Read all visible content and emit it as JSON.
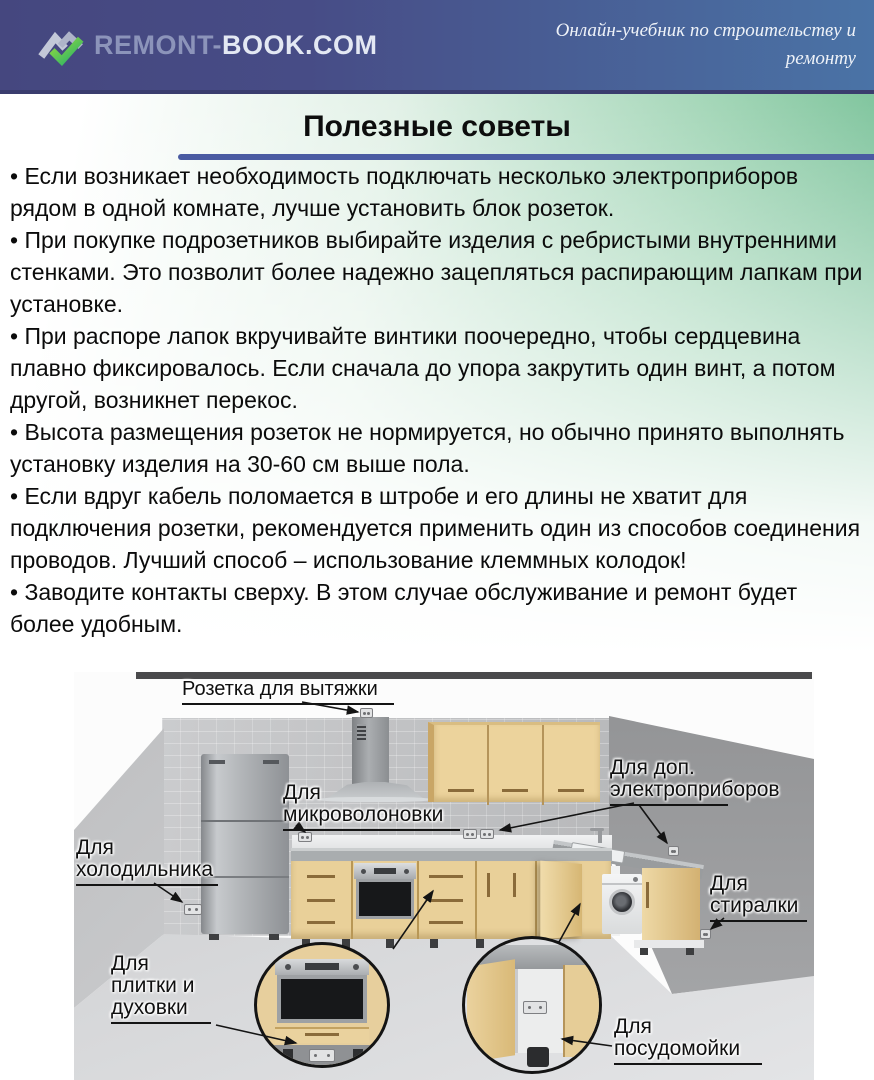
{
  "header": {
    "brand_primary": "REMONT-",
    "brand_secondary": "BOOK.COM",
    "tagline_line1": "Онлайн-учебник по строительству и",
    "tagline_line2": "ремонту"
  },
  "page": {
    "title": "Полезные советы"
  },
  "tips": [
    "• Если возникает необходимость подключать несколько электроприборов рядом в одной комнате, лучше установить блок розеток.",
    "• При покупке подрозетников выбирайте изделия с ребристыми внутренними стенками. Это позволит более надежно зацепляться распирающим лапкам при установке.",
    "• При распоре лапок вкручивайте винтики поочередно, чтобы сердцевина плавно фиксировалось. Если сначала до упора закрутить один винт, а потом другой, возникнет перекос.",
    "• Высота размещения розеток не нормируется, но обычно принято выполнять установку изделия на 30-60 см выше пола.",
    "• Если вдруг кабель поломается в штробе и его длины не хватит для подключения розетки, рекомендуется применить один из способов соединения проводов. Лучший способ – использование клеммных колодок!",
    "• Заводите контакты сверху. В этом случае обслуживание и ремонт будет более удобным."
  ],
  "diagram": {
    "labels": {
      "hood_socket": "Розетка для вытяжки",
      "microwave_l1": "Для",
      "microwave_l2": "микроволоновки",
      "extra_l1": "Для доп.",
      "extra_l2": "электроприборов",
      "fridge_l1": "Для",
      "fridge_l2": "холодильника",
      "washer_l1": "Для",
      "washer_l2": "стиралки",
      "stove_l1": "Для",
      "stove_l2": "плитки и",
      "stove_l3": "духовки",
      "dishwasher_l1": "Для",
      "dishwasher_l2": "посудомойки"
    }
  },
  "colors": {
    "header_left": "#45477f",
    "header_right": "#4a73a6",
    "header_rule": "#3a3d6e",
    "accent_green": "#35ab7f",
    "title_rule": "#4a5ba2",
    "bg_green": "#5cb384"
  }
}
